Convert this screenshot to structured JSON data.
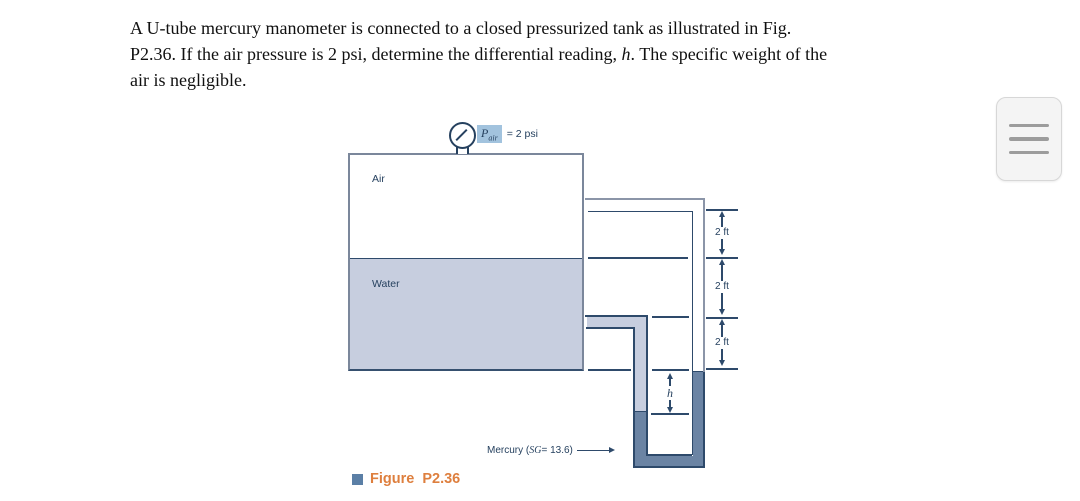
{
  "problem_statement": {
    "line1": "A U-tube mercury manometer is connected to a closed pressurized tank as illustrated in Fig.",
    "line2_pre": "P2.36. If the air pressure is 2 psi, determine the differential reading, ",
    "line2_h": "h",
    "line2_post": ". The specific weight of the",
    "line3": "air is negligible."
  },
  "figure": {
    "gauge": {
      "p": "P",
      "sub": "air",
      "value": "= 2 psi"
    },
    "air_label": "Air",
    "water_label": "Water",
    "mercury_label": {
      "prefix": "Mercury (",
      "sg": "SG",
      "suffix": " = 13.6)"
    },
    "dims": [
      "2 ft",
      "2 ft",
      "2 ft"
    ],
    "h_label": "h",
    "caption": "Figure P2.36"
  },
  "menu": {
    "icon_name": "hamburger-menu-icon"
  },
  "colors": {
    "line_navy": "#2e4a6b",
    "tube_outer_gray": "#8b95a8",
    "water_fill": "#c7cedf",
    "mercury_fill": "#6b84a4",
    "gauge_highlight": "#a2c3de",
    "caption_orange": "#de7f3e",
    "caption_square_blue": "#5b7fa6"
  }
}
